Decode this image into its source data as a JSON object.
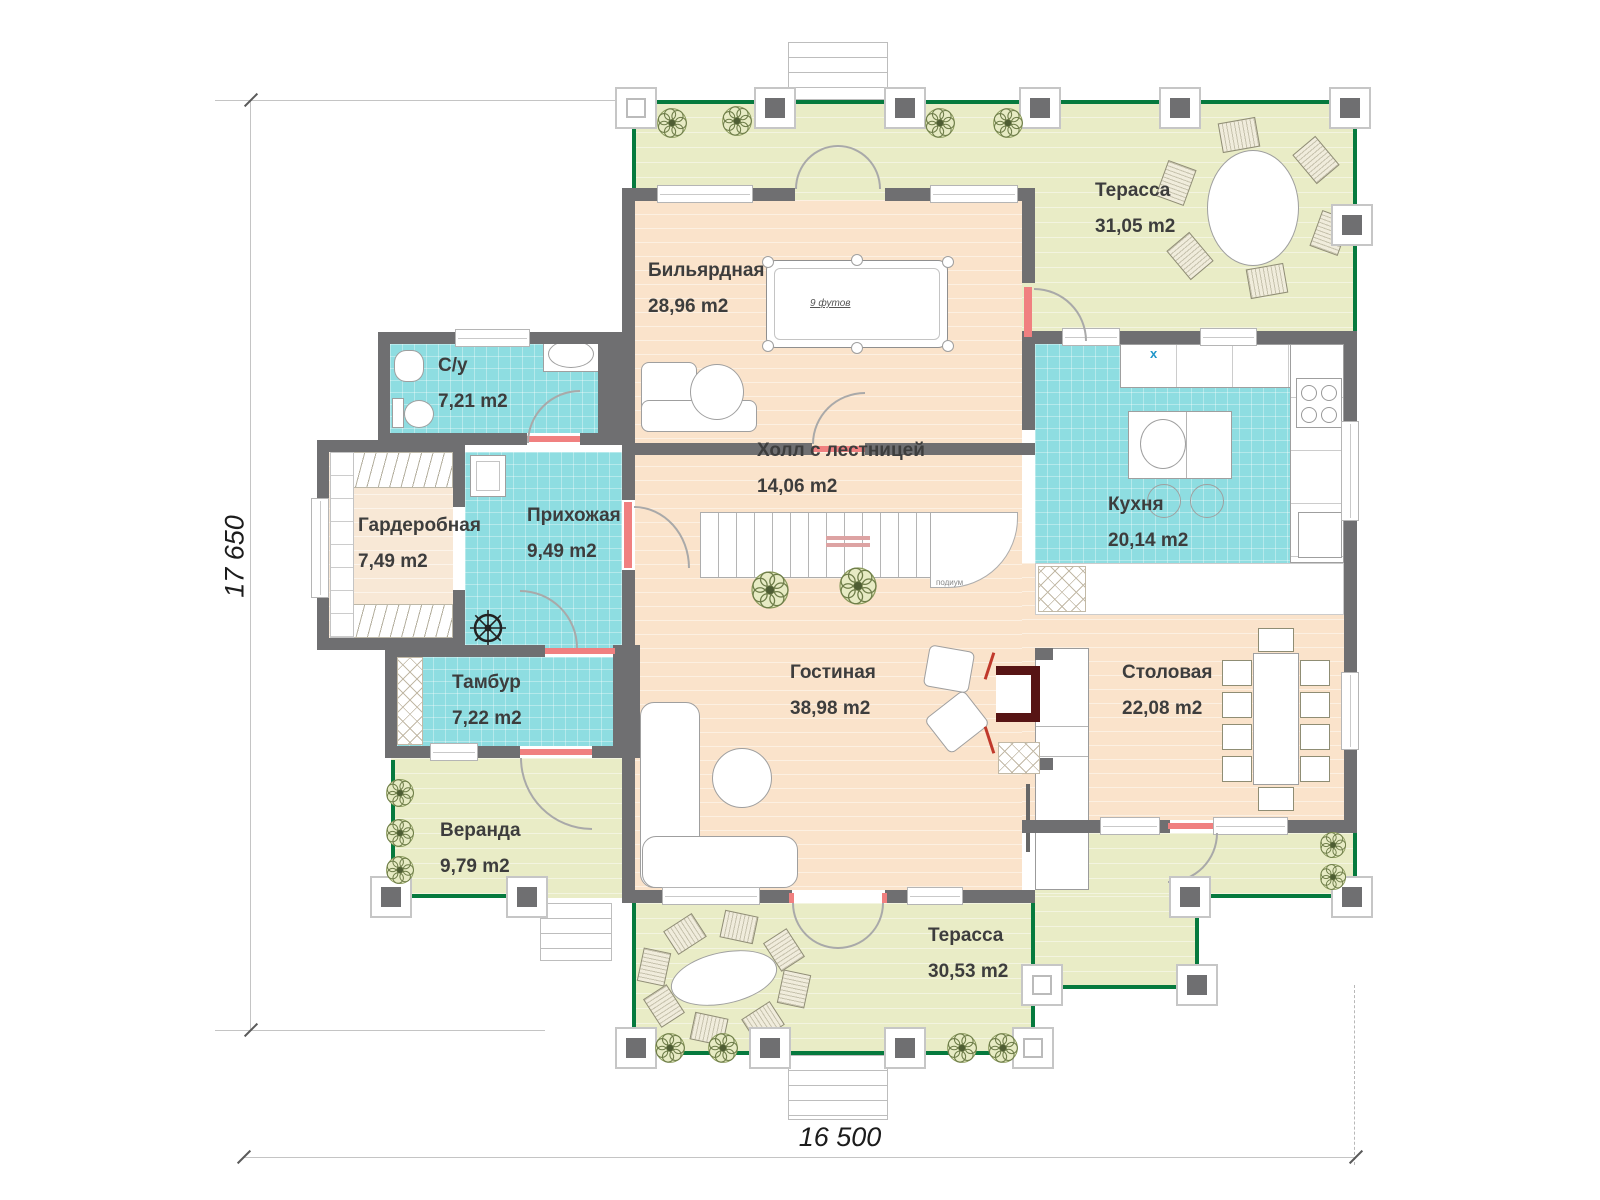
{
  "rooms": [
    {
      "id": "terrace-top",
      "name": "Терасса",
      "area": "31,05 m2"
    },
    {
      "id": "billiard",
      "name": "Бильярдная",
      "area": "28,96 m2"
    },
    {
      "id": "bathroom",
      "name": "С/у",
      "area": "7,21 m2"
    },
    {
      "id": "wardrobe",
      "name": "Гардеробная",
      "area": "7,49 m2"
    },
    {
      "id": "entry",
      "name": "Прихожая",
      "area": "9,49 m2"
    },
    {
      "id": "hall",
      "name": "Холл с лестницей",
      "area": "14,06 m2"
    },
    {
      "id": "kitchen",
      "name": "Кухня",
      "area": "20,14 m2"
    },
    {
      "id": "vestibule",
      "name": "Тамбур",
      "area": "7,22 m2"
    },
    {
      "id": "living",
      "name": "Гостиная",
      "area": "38,98 m2"
    },
    {
      "id": "dining",
      "name": "Столовая",
      "area": "22,08 m2"
    },
    {
      "id": "veranda",
      "name": "Веранда",
      "area": "9,79 m2"
    },
    {
      "id": "terrace-bottom",
      "name": "Терасса",
      "area": "30,53 m2"
    }
  ],
  "dimensions": {
    "height": "17 650",
    "width": "16 500"
  },
  "annotations": {
    "billiard_table": "9 футов",
    "stairs_podium": "подиум",
    "kitchen_mark": "x"
  },
  "colors": {
    "terrace": "#e9ecc6",
    "floor": "#fae3cb",
    "wet_rooms": "#8edde1",
    "wall": "#6f6f71",
    "railing": "#067a3e",
    "accent_red": "#c0392b",
    "fireplace": "#571414"
  }
}
